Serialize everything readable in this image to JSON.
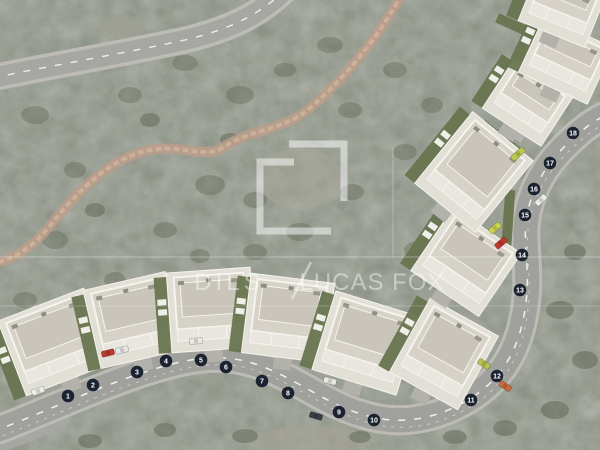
{
  "watermark": {
    "brand_left": "DILS",
    "separator": "/",
    "brand_right": "LUCAS FOX",
    "logo": "square-bracket-logo",
    "color": "#FFFFFF"
  },
  "site_plan": {
    "plot_markers": [
      {
        "label": "1",
        "x": 68,
        "y": 396
      },
      {
        "label": "2",
        "x": 93,
        "y": 385
      },
      {
        "label": "3",
        "x": 137,
        "y": 372
      },
      {
        "label": "4",
        "x": 166,
        "y": 361
      },
      {
        "label": "5",
        "x": 201,
        "y": 360
      },
      {
        "label": "6",
        "x": 226,
        "y": 367
      },
      {
        "label": "7",
        "x": 262,
        "y": 381
      },
      {
        "label": "8",
        "x": 288,
        "y": 393
      },
      {
        "label": "9",
        "x": 339,
        "y": 412
      },
      {
        "label": "10",
        "x": 374,
        "y": 420
      },
      {
        "label": "11",
        "x": 471,
        "y": 400
      },
      {
        "label": "12",
        "x": 497,
        "y": 376
      },
      {
        "label": "13",
        "x": 520,
        "y": 290
      },
      {
        "label": "14",
        "x": 522,
        "y": 255
      },
      {
        "label": "15",
        "x": 525,
        "y": 215
      },
      {
        "label": "16",
        "x": 534,
        "y": 189
      },
      {
        "label": "17",
        "x": 550,
        "y": 163
      },
      {
        "label": "18",
        "x": 573,
        "y": 133
      }
    ],
    "buildings": [
      {
        "cx": 55,
        "cy": 342,
        "w": 92,
        "h": 80,
        "rot": -21
      },
      {
        "cx": 133,
        "cy": 320,
        "w": 84,
        "h": 80,
        "rot": -13
      },
      {
        "cx": 211,
        "cy": 310,
        "w": 84,
        "h": 80,
        "rot": -4
      },
      {
        "cx": 288,
        "cy": 318,
        "w": 84,
        "h": 80,
        "rot": 7
      },
      {
        "cx": 366,
        "cy": 343,
        "w": 88,
        "h": 82,
        "rot": 17
      },
      {
        "cx": 444,
        "cy": 354,
        "w": 78,
        "h": 84,
        "rot": 29
      },
      {
        "cx": 466,
        "cy": 262,
        "w": 82,
        "h": 76,
        "rot": 34
      },
      {
        "cx": 474,
        "cy": 172,
        "w": 78,
        "h": 92,
        "rot": 39
      },
      {
        "cx": 528,
        "cy": 102,
        "w": 70,
        "h": 60,
        "rot": 33
      },
      {
        "cx": 566,
        "cy": 60,
        "w": 76,
        "h": 62,
        "rot": 25
      },
      {
        "cx": 562,
        "cy": 8,
        "w": 72,
        "h": 56,
        "rot": 22
      }
    ],
    "gardens": [
      {
        "cx": 432,
        "cy": 314,
        "w": 12,
        "h": 56,
        "rot": 30
      },
      {
        "cx": 508,
        "cy": 222,
        "w": 10,
        "h": 64,
        "rot": 4
      },
      {
        "cx": 500,
        "cy": 138,
        "w": 46,
        "h": 10,
        "rot": 38
      },
      {
        "cx": 548,
        "cy": 80,
        "w": 50,
        "h": 10,
        "rot": 25
      },
      {
        "cx": 520,
        "cy": 28,
        "w": 50,
        "h": 10,
        "rot": 24
      }
    ],
    "cars": [
      {
        "x": 38,
        "y": 391,
        "rot": -20,
        "color": "#EEEEE8"
      },
      {
        "x": 108,
        "y": 353,
        "rot": -14,
        "color": "#B83A30"
      },
      {
        "x": 122,
        "y": 350,
        "rot": -14,
        "color": "#E8E8E4"
      },
      {
        "x": 196,
        "y": 341,
        "rot": -4,
        "color": "#ECEAE4"
      },
      {
        "x": 330,
        "y": 381,
        "rot": 14,
        "color": "#E8E7E2"
      },
      {
        "x": 316,
        "y": 416,
        "rot": 16,
        "color": "#3A3F46"
      },
      {
        "x": 484,
        "y": 364,
        "rot": 33,
        "color": "#B7C24D"
      },
      {
        "x": 505,
        "y": 386,
        "rot": 33,
        "color": "#C96A3C"
      },
      {
        "x": 495,
        "y": 228,
        "rot": -40,
        "color": "#CDD74E"
      },
      {
        "x": 501,
        "y": 243,
        "rot": -40,
        "color": "#C0392B"
      },
      {
        "x": 518,
        "y": 154,
        "rot": -42,
        "color": "#B9C84F",
        "w": 16
      },
      {
        "x": 541,
        "y": 200,
        "rot": -42,
        "color": "#ECECE8"
      }
    ],
    "colors": {
      "terrain": "#8C9186",
      "road": "#A0A09C",
      "road_shoulder": "#BDBBB5",
      "trail": "#BC9D89",
      "marker_bg": "#1C2330",
      "marker_text": "#FFFFFF",
      "roof": "#D6D2C7",
      "roof_light": "#F5F3EE",
      "roof_dark": "#C9C5BA",
      "terrace": "#E2DFD7",
      "garden": "#68744F",
      "watermark": "#FFFFFF"
    }
  }
}
